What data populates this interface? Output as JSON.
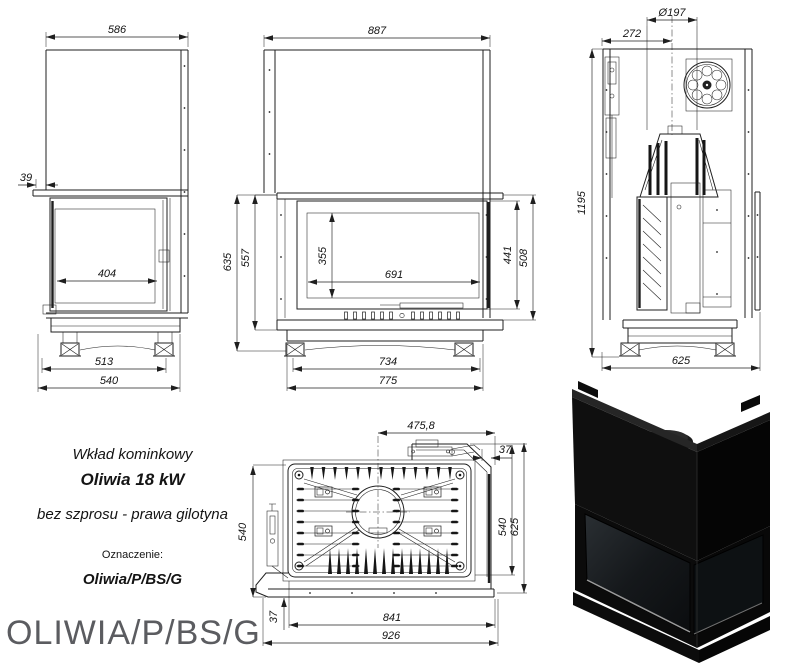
{
  "product": {
    "category": "Wkład kominkowy",
    "model": "Oliwia 18 kW",
    "variant": "bez szprosu - prawa gilotyna",
    "designation_label": "Oznaczenie:",
    "designation": "Oliwia/P/BS/G"
  },
  "footer": {
    "code": "OLIWIA/P/BS/G"
  },
  "dimensions": {
    "left_side_view": {
      "width_top": "586",
      "front_offset": "39",
      "glass_width": "404",
      "feet_span": "513",
      "depth": "540"
    },
    "front_view": {
      "width_top": "887",
      "height_body": "635",
      "height_hood": "557",
      "glass_height": "355",
      "glass_width": "691",
      "door_height": "441",
      "front_panel_height": "508",
      "feet_span": "734",
      "width_base": "775"
    },
    "right_side_view": {
      "flue_diameter": "Ø197",
      "flue_axis_offset": "272",
      "height_total": "1195",
      "depth_base": "625"
    },
    "top_view": {
      "flue_axis_to_glass": "475,8",
      "glass_offset_right": "37",
      "depth_plate_left": "540",
      "depth_plate_right": "540",
      "depth_total": "625",
      "frame_offset_front": "37",
      "width_plate": "841",
      "width_total": "926"
    }
  },
  "colors": {
    "drawing_line": "#1f1f1f",
    "footer_text": "#5b5c60",
    "render_body": "#0d0d0d"
  }
}
